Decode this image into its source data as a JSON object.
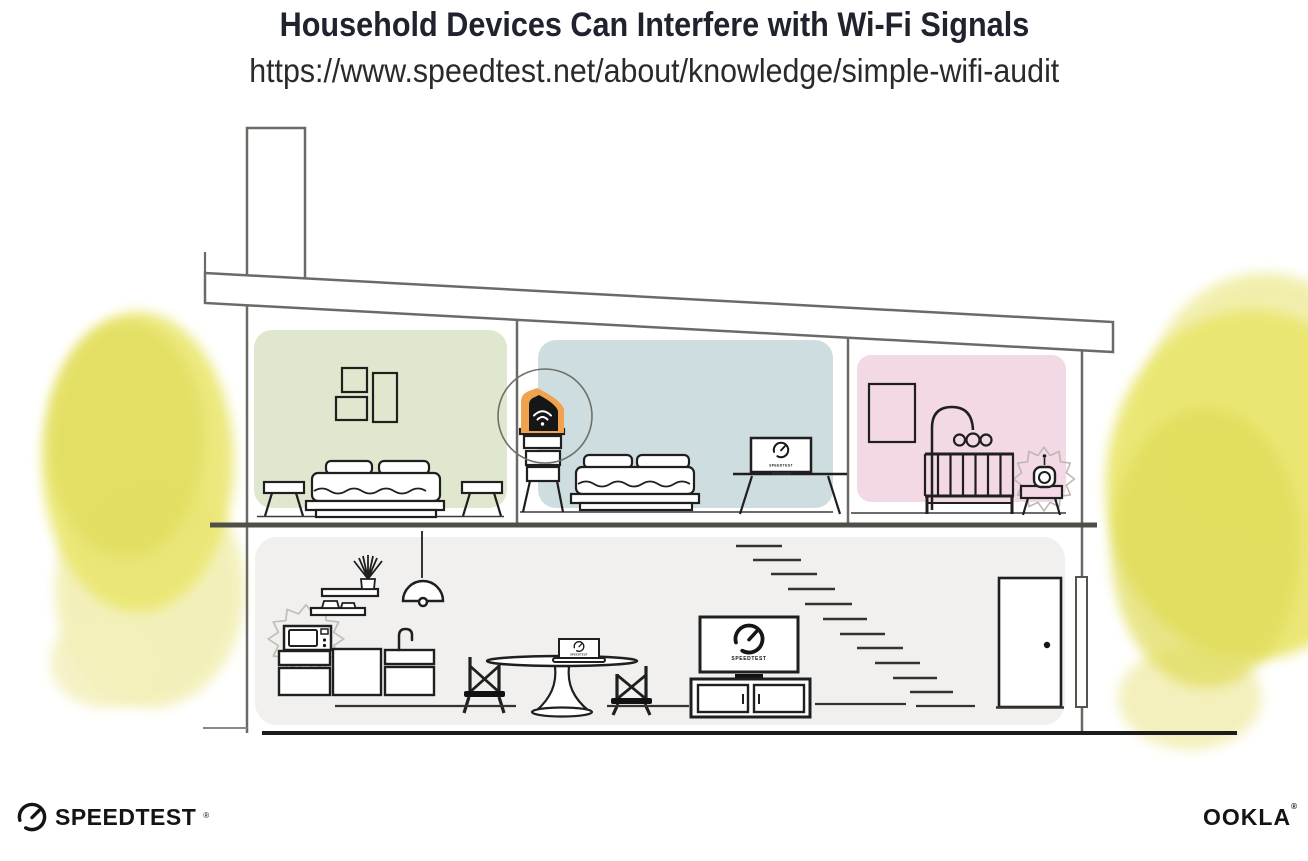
{
  "header": {
    "title": "Household Devices Can Interfere with Wi-Fi Signals",
    "url": "https://www.speedtest.net/about/knowledge/simple-wifi-audit"
  },
  "screens": {
    "tv_label": "SPEEDTEST",
    "bedroom_monitor_label": "SPEEDTEST",
    "dining_laptop_label": "SPEEDTEST"
  },
  "footer": {
    "speedtest_label": "SPEEDTEST",
    "speedtest_trademark": "®",
    "ookla_label": "OOKLA",
    "ookla_trademark": "®"
  },
  "illustration": {
    "subject": "Two-story house cross-section with Wi-Fi interference sources",
    "highlighted_devices": [
      "wi-fi router",
      "microwave",
      "baby monitor"
    ],
    "colors": {
      "bedroom_left_wall": "#dfe8ce",
      "bedroom_middle_wall": "#cedde0",
      "nursery_wall": "#f3d8e5",
      "ground_floor_wall": "#f1f0ee",
      "router_highlight_orange": "#f0a24c",
      "foliage_yellow": "#e5e170",
      "structure_line": "#6b6b66",
      "furniture_line": "#1f1f1f",
      "title_text": "#20222e"
    }
  }
}
